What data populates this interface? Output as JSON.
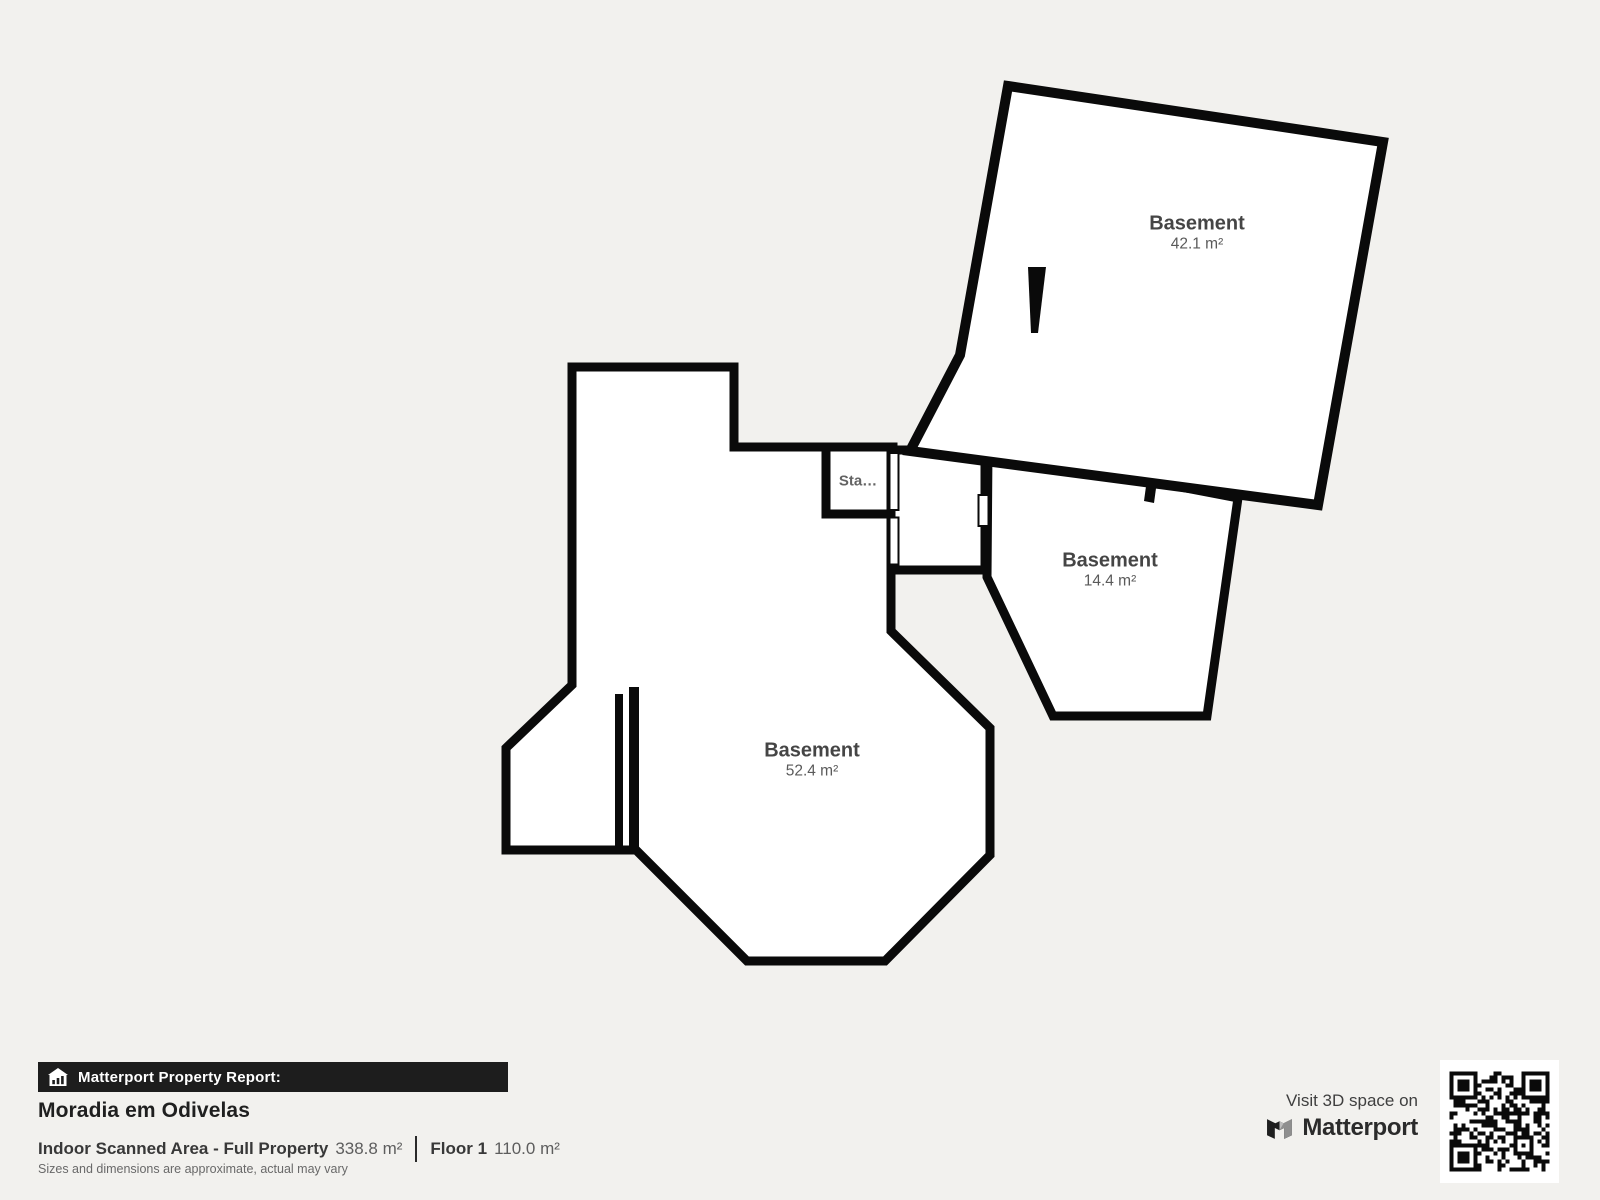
{
  "floorplan": {
    "rooms": [
      {
        "label": "Basement",
        "area": "42.1 m²"
      },
      {
        "label": "Basement",
        "area": "14.4 m²"
      },
      {
        "label": "Basement",
        "area": "52.4 m²"
      }
    ],
    "stairs_label": "Sta…"
  },
  "footer": {
    "report_banner": "Matterport Property Report:",
    "property_name": "Moradia em Odivelas",
    "scanned_area_label": "Indoor Scanned Area - Full Property",
    "scanned_area_value": "338.8 m²",
    "floor_label": "Floor 1",
    "floor_value": "110.0 m²",
    "disclaimer": "Sizes and dimensions are approximate, actual may vary"
  },
  "cta": {
    "visit_text": "Visit 3D space on",
    "brand": "Matterport"
  },
  "colors": {
    "background": "#f2f1ee",
    "wall": "#0a0a0a",
    "room_fill": "#ffffff",
    "banner_bg": "#1d1d1d",
    "label_text": "#454545"
  }
}
